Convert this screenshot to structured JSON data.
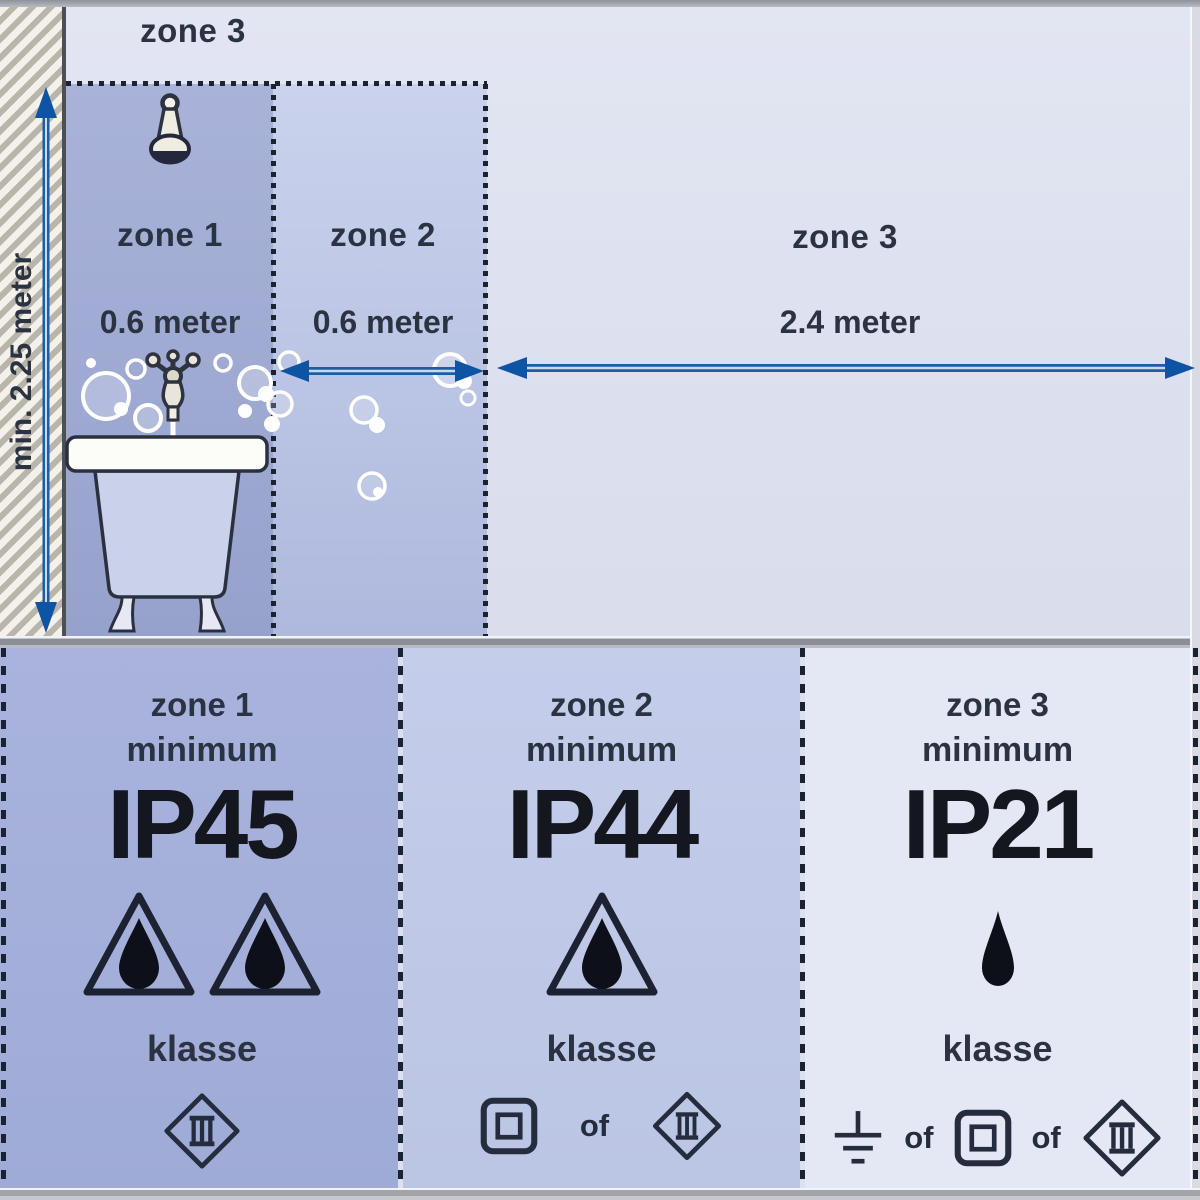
{
  "diagram": {
    "top": {
      "ceiling_zone_label": "zone 3",
      "height_dimension": "min. 2.25 meter",
      "zones": [
        {
          "name": "zone 1",
          "dimension": "0.6 meter"
        },
        {
          "name": "zone 2",
          "dimension": "0.6 meter"
        },
        {
          "name": "zone 3",
          "dimension": "2.4 meter"
        }
      ],
      "fixtures": [
        "shower-head-icon",
        "faucet-icon",
        "bathtub-icon",
        "bubbles"
      ]
    },
    "panels": [
      {
        "zone": "zone 1",
        "minimum_label": "minimum",
        "ip_rating": "IP45",
        "klasse_label": "klasse",
        "protection_icons": [
          "triangle-droplet-icon",
          "triangle-droplet-icon"
        ],
        "class_row": [
          {
            "icon": "diamond-class-3-icon"
          }
        ]
      },
      {
        "zone": "zone 2",
        "minimum_label": "minimum",
        "ip_rating": "IP44",
        "klasse_label": "klasse",
        "protection_icons": [
          "triangle-droplet-icon"
        ],
        "class_row": [
          {
            "icon": "square-class-2-icon"
          },
          {
            "text": "of"
          },
          {
            "icon": "diamond-class-3-icon"
          }
        ]
      },
      {
        "zone": "zone 3",
        "minimum_label": "minimum",
        "ip_rating": "IP21",
        "klasse_label": "klasse",
        "protection_icons": [
          "droplet-icon"
        ],
        "class_row": [
          {
            "icon": "earth-class-1-icon"
          },
          {
            "text": "of"
          },
          {
            "icon": "square-class-2-icon"
          },
          {
            "text": "of"
          },
          {
            "icon": "diamond-class-3-icon"
          }
        ]
      }
    ],
    "colors": {
      "zone1_fill": "#9aa6d0",
      "zone2_fill": "#bcc5e3",
      "zone3_fill": "#dde1ef",
      "panel1_fill": "#a4afd9",
      "panel2_fill": "#bfc9e6",
      "panel3_fill": "#e4e7f4",
      "arrow_blue": "#1258a6",
      "text_dark": "#2b3342",
      "dotted_line": "#1b2231",
      "wall_hatch": "#b9b5ab"
    }
  }
}
